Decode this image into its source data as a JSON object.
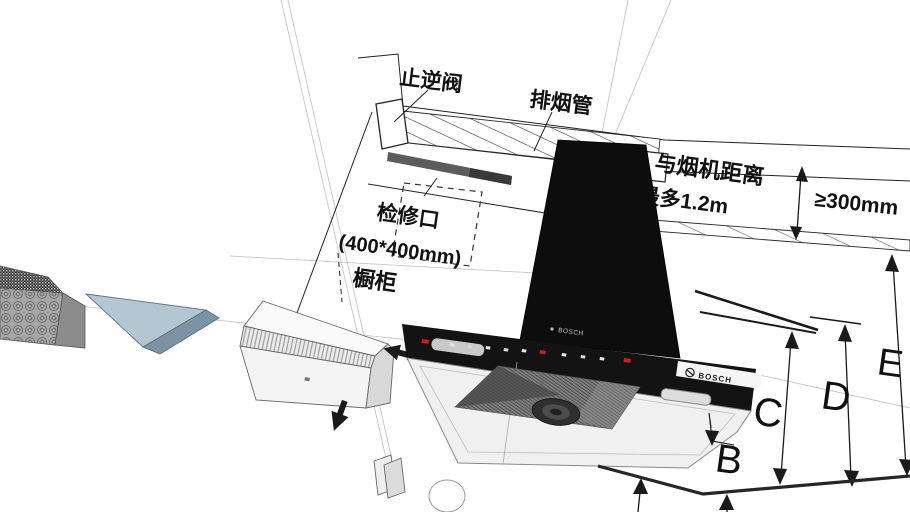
{
  "annotations": {
    "check_valve": "止逆阀",
    "exhaust_duct": "排烟管",
    "inspection_port": "检修口",
    "inspection_port_size": "(400*400mm)",
    "cabinet": "橱柜",
    "hood_distance_line1": "与烟机距离",
    "hood_distance_line2": "最多1.2m",
    "min_clearance": "≥300mm"
  },
  "dimensions": {
    "b": "B",
    "c": "C",
    "d": "D",
    "e": "E"
  },
  "hood": {
    "brand_top": "BOSCH",
    "brand_logo": "BOSCH"
  },
  "colors": {
    "hood_black": "#121212",
    "accent_red": "#c8201d",
    "part_blue_light": "#b4c6d2",
    "part_blue_dark": "#7b93a2",
    "annotation": "#1a1a1a",
    "background": "#ffffff"
  }
}
